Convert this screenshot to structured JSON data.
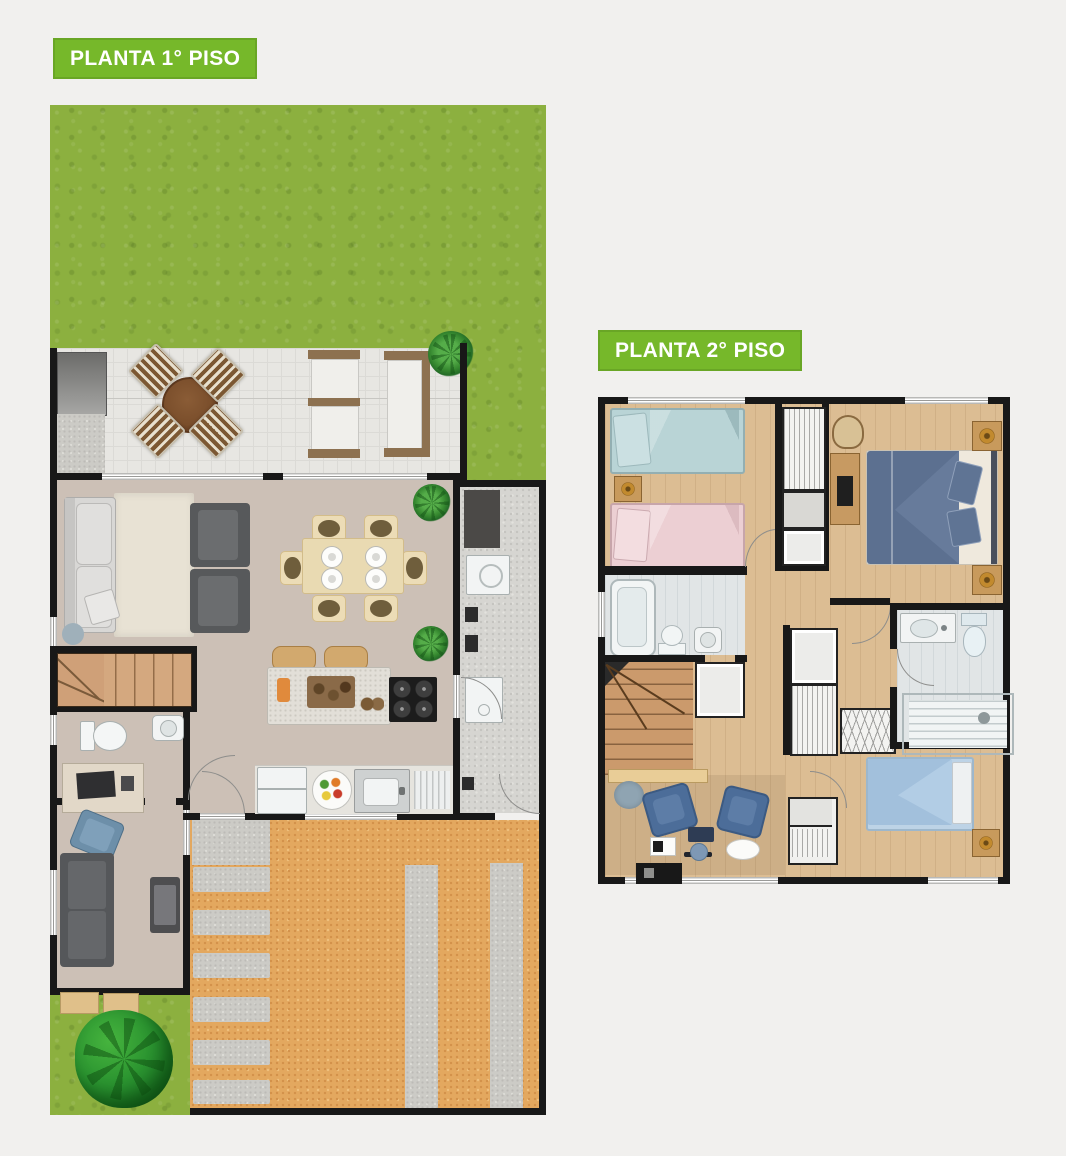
{
  "badges": {
    "floor1_label": "PLANTA 1° PISO",
    "floor2_label": "PLANTA 2° PISO"
  },
  "colors": {
    "badge_green": "#76b82a",
    "background": "#f1f0ee",
    "grass": "#8cb03f",
    "patio_tile": "#e7e6e2",
    "interior_floor": "#ccc0b6",
    "wood_floor": "#dcbd93",
    "driveway": "#e3a85f",
    "wall": "#181818",
    "master_bed_blue": "#5c7090",
    "kids_bed_teal": "#b9d4d6",
    "kids_bed_pink": "#eccfd3",
    "single_bed_blue": "#a2c0dc"
  }
}
